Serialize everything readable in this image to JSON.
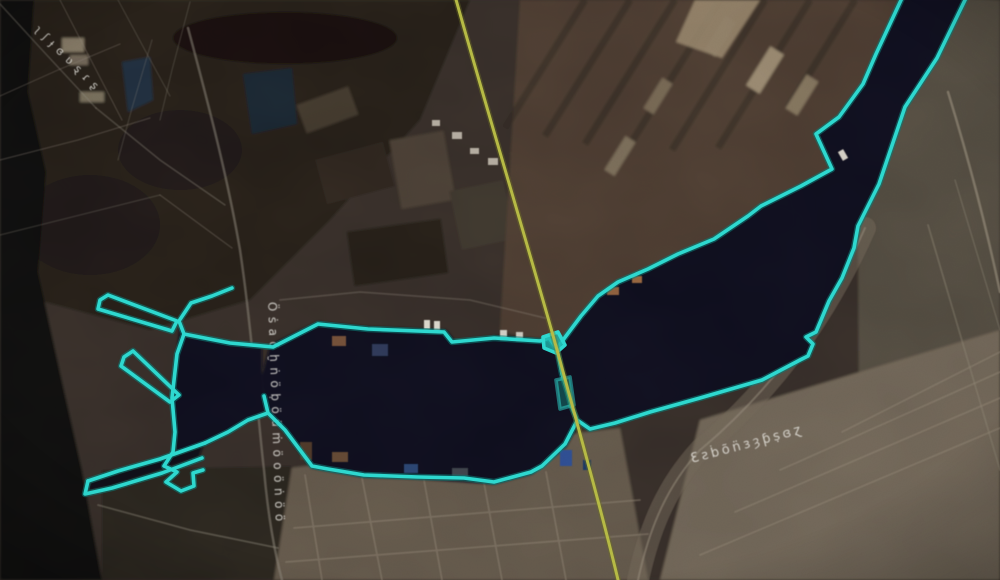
{
  "scene": {
    "kind": "satellite-aerial-view",
    "subject": "industrial harbor with two basins, piers and a connecting channel",
    "colors": {
      "boundary": "#2ed8cf",
      "boundary_shadow": "#0b7f78",
      "survey_line": "#b6ba45",
      "survey_line_shadow": "#6e7022",
      "water": "#0a0f1a",
      "label_text": "#e9e7e1"
    }
  },
  "overlay": {
    "paths": {
      "main_outline": "M232,288 L212,296 L191,303 L179,321 L184,334 L230,343 L273,347 L318,324 L368,329 L444,332 L452,342 L494,338 L540,341 L549,338 L557,349 L562,374 L568,393 L571,405 L577,420 L590,429 L615,423 L650,412 L700,398 L762,380 L800,360 L808,356 L813,344 L806,337 L816,332 L829,301 L842,278 L854,248 L858,226 L879,184 L905,107 L937,58 L966,-2",
      "northeast_shore": "M902,-2 L876,54 L863,84 L839,117 L816,134 L832,169 L801,186 L761,206 L748,216 L714,239 L678,254 L648,269 L618,282 L598,296 L581,316 L566,336 L558,347",
      "south_shore": "M577,421 L565,444 L542,466 L531,472 L494,482 L464,478 L418,477 L364,475 L328,469 L312,466 L285,430 L268,413 L264,396 M268,413 L248,420 L228,432 L205,443",
      "west_hook": "M184,334 L177,354 L172,398 L175,432 L173,452 L164,466 L177,472 L166,482 L181,491 L194,486 L193,473 L203,470",
      "pier_a": "M100,300 L108,295 L177,321 L172,331 L98,309 Z",
      "pier_b": "M124,357 L133,351 L179,395 L170,402 L121,366 Z",
      "arm_north": "M205,443 L160,459 L118,471 L88,481",
      "arm_south": "M88,481 L85,494 L112,488 L162,473 L202,458",
      "mouth_patch": "M543,337 L558,332 L565,345 L556,353 L544,348 Z",
      "mouth_patch2": "M556,380 L570,377 L574,405 L560,409 Z"
    },
    "survey_line_d": "M455,-4 C492,128 536,272 562,368 C580,434 602,512 619,584"
  },
  "labels": {
    "topleft_road": {
      "text": "ʅʃɟɞʋȿɾʂ"
    },
    "vertical_street": {
      "text": "Öṡaöḫṅöḅöüṁöoöṅöö"
    },
    "southeast_road": {
      "text": "Ɛƨḃõn̈ɜȝƥṣɞɀ"
    }
  }
}
